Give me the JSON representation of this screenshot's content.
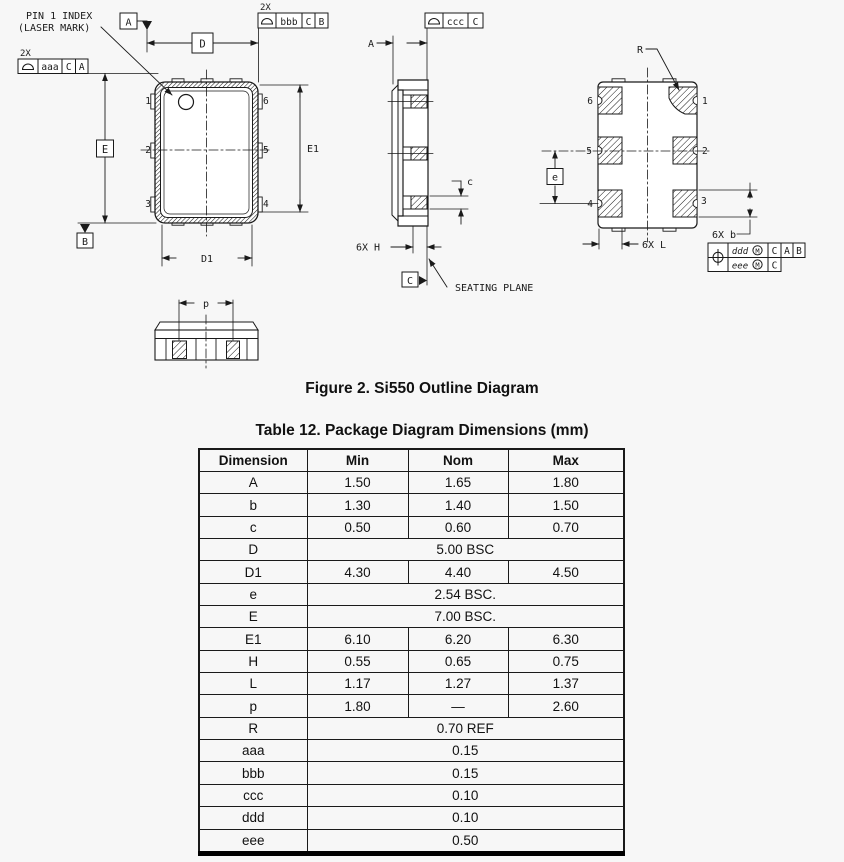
{
  "figure": {
    "caption": "Figure 2. Si550 Outline Diagram"
  },
  "table": {
    "caption": "Table 12. Package Diagram Dimensions (mm)",
    "headers": [
      "Dimension",
      "Min",
      "Nom",
      "Max"
    ],
    "rows": [
      {
        "dim": "A",
        "cells": [
          "1.50",
          "1.65",
          "1.80"
        ]
      },
      {
        "dim": "b",
        "cells": [
          "1.30",
          "1.40",
          "1.50"
        ]
      },
      {
        "dim": "c",
        "cells": [
          "0.50",
          "0.60",
          "0.70"
        ]
      },
      {
        "dim": "D",
        "span": "5.00 BSC"
      },
      {
        "dim": "D1",
        "cells": [
          "4.30",
          "4.40",
          "4.50"
        ]
      },
      {
        "dim": "e",
        "span": "2.54 BSC."
      },
      {
        "dim": "E",
        "span": "7.00 BSC."
      },
      {
        "dim": "E1",
        "cells": [
          "6.10",
          "6.20",
          "6.30"
        ]
      },
      {
        "dim": "H",
        "cells": [
          "0.55",
          "0.65",
          "0.75"
        ]
      },
      {
        "dim": "L",
        "cells": [
          "1.17",
          "1.27",
          "1.37"
        ]
      },
      {
        "dim": "p",
        "cells": [
          "1.80",
          "—",
          "2.60"
        ]
      },
      {
        "dim": "R",
        "span": "0.70 REF"
      },
      {
        "dim": "aaa",
        "span": "0.15"
      },
      {
        "dim": "bbb",
        "span": "0.15"
      },
      {
        "dim": "ccc",
        "span": "0.10"
      },
      {
        "dim": "ddd",
        "span": "0.10"
      },
      {
        "dim": "eee",
        "span": "0.50"
      }
    ]
  },
  "diagram": {
    "pin1_note": {
      "line1": "PIN 1 INDEX",
      "line2": "(LASER MARK)"
    },
    "fcf_aaa": {
      "qty": "2X",
      "symbol": "profile-of-surface-icon",
      "tol": "aaa",
      "d1": "C",
      "d2": "A"
    },
    "fcf_bbb": {
      "qty": "2X",
      "symbol": "profile-of-surface-icon",
      "tol": "bbb",
      "d1": "C",
      "d2": "B"
    },
    "fcf_ccc": {
      "symbol": "profile-of-surface-icon",
      "tol": "ccc",
      "d1": "C"
    },
    "fcf_pos": {
      "symbol": "position-icon",
      "row1": {
        "tol": "ddd",
        "mod": "M",
        "d1": "C",
        "d2": "A",
        "d3": "B"
      },
      "row2": {
        "tol": "eee",
        "mod": "M",
        "d1": "C"
      }
    },
    "datum_a": "A",
    "datum_b": "B",
    "datum_c": "C",
    "dim_d": "D",
    "dim_e_big": "E",
    "dim_e1": "E1",
    "dim_d1": "D1",
    "dim_a": "A",
    "dim_c": "c",
    "dim_h": "6X H",
    "dim_e_small": "e",
    "dim_l": "6X L",
    "dim_b": "6X b",
    "dim_r": "R",
    "dim_p": "p",
    "seating_plane": "SEATING PLANE",
    "top_pins": {
      "p1": "1",
      "p2": "2",
      "p3": "3",
      "p4": "4",
      "p5": "5",
      "p6": "6"
    },
    "bottom_pins": {
      "p1": "1",
      "p2": "2",
      "p3": "3",
      "p4": "4",
      "p5": "5",
      "p6": "6"
    }
  }
}
